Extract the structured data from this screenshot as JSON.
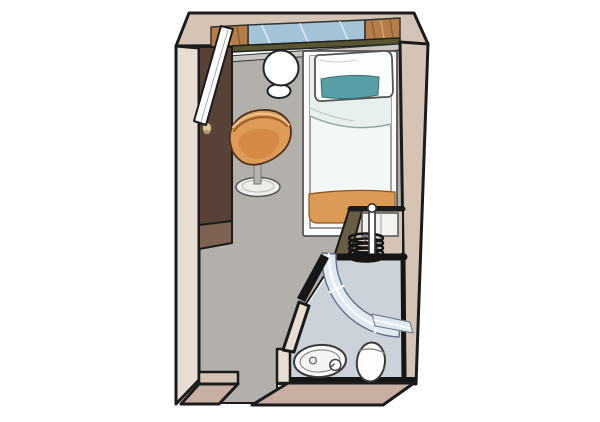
{
  "title": "cabin-floor-plan",
  "colors": {
    "background": "#ffffff",
    "outline": "#1b1b1b",
    "wall_top": "#d5c4b6",
    "wall_left": "#e8ddd2",
    "wall_bottom": "#c7afa1",
    "floor": "#b3b0ab",
    "bath_floor": "#cbd2da",
    "ledge": "#c9c6c1",
    "wardrobe": "#584238",
    "wardrobe_side": "#7d6354",
    "knob": "#dcc79c",
    "door_white": "#ffffff",
    "table_white": "#ffffff",
    "chair": "#e09a58",
    "chair_shade": "#d08440",
    "chair_base": "#efede9",
    "chair_stem": "#b7b4ae",
    "bed_platform": "#fbfcfb",
    "duvet_light": "#f3f8f7",
    "duvet_tint": "#e7f0ee",
    "pillow_white": "#fcfdfd",
    "pillow_teal": "#579ea6",
    "blanket_orange": "#dc9a57",
    "window_glass": "#a4c3d6",
    "curtain_brown": "#b57d49",
    "sill_olive": "#585631",
    "unit_olive": "#695e44",
    "unit_white": "#f4f3ef",
    "shower_glass": "#dfe9f1",
    "fixture_white": "#fdfdfd"
  },
  "elements": {
    "rooms": [
      {
        "name": "cabin-main-room"
      },
      {
        "name": "bathroom"
      }
    ],
    "furniture": [
      {
        "name": "window-with-curtains"
      },
      {
        "name": "open-door-panel"
      },
      {
        "name": "wardrobe"
      },
      {
        "name": "round-table"
      },
      {
        "name": "stool"
      },
      {
        "name": "swivel-chair"
      },
      {
        "name": "single-bed"
      },
      {
        "name": "teal-pillow"
      },
      {
        "name": "orange-foot-blanket"
      },
      {
        "name": "bedside-unit-with-coil"
      },
      {
        "name": "curved-glass-shower"
      },
      {
        "name": "washbasin"
      },
      {
        "name": "toilet"
      }
    ]
  }
}
